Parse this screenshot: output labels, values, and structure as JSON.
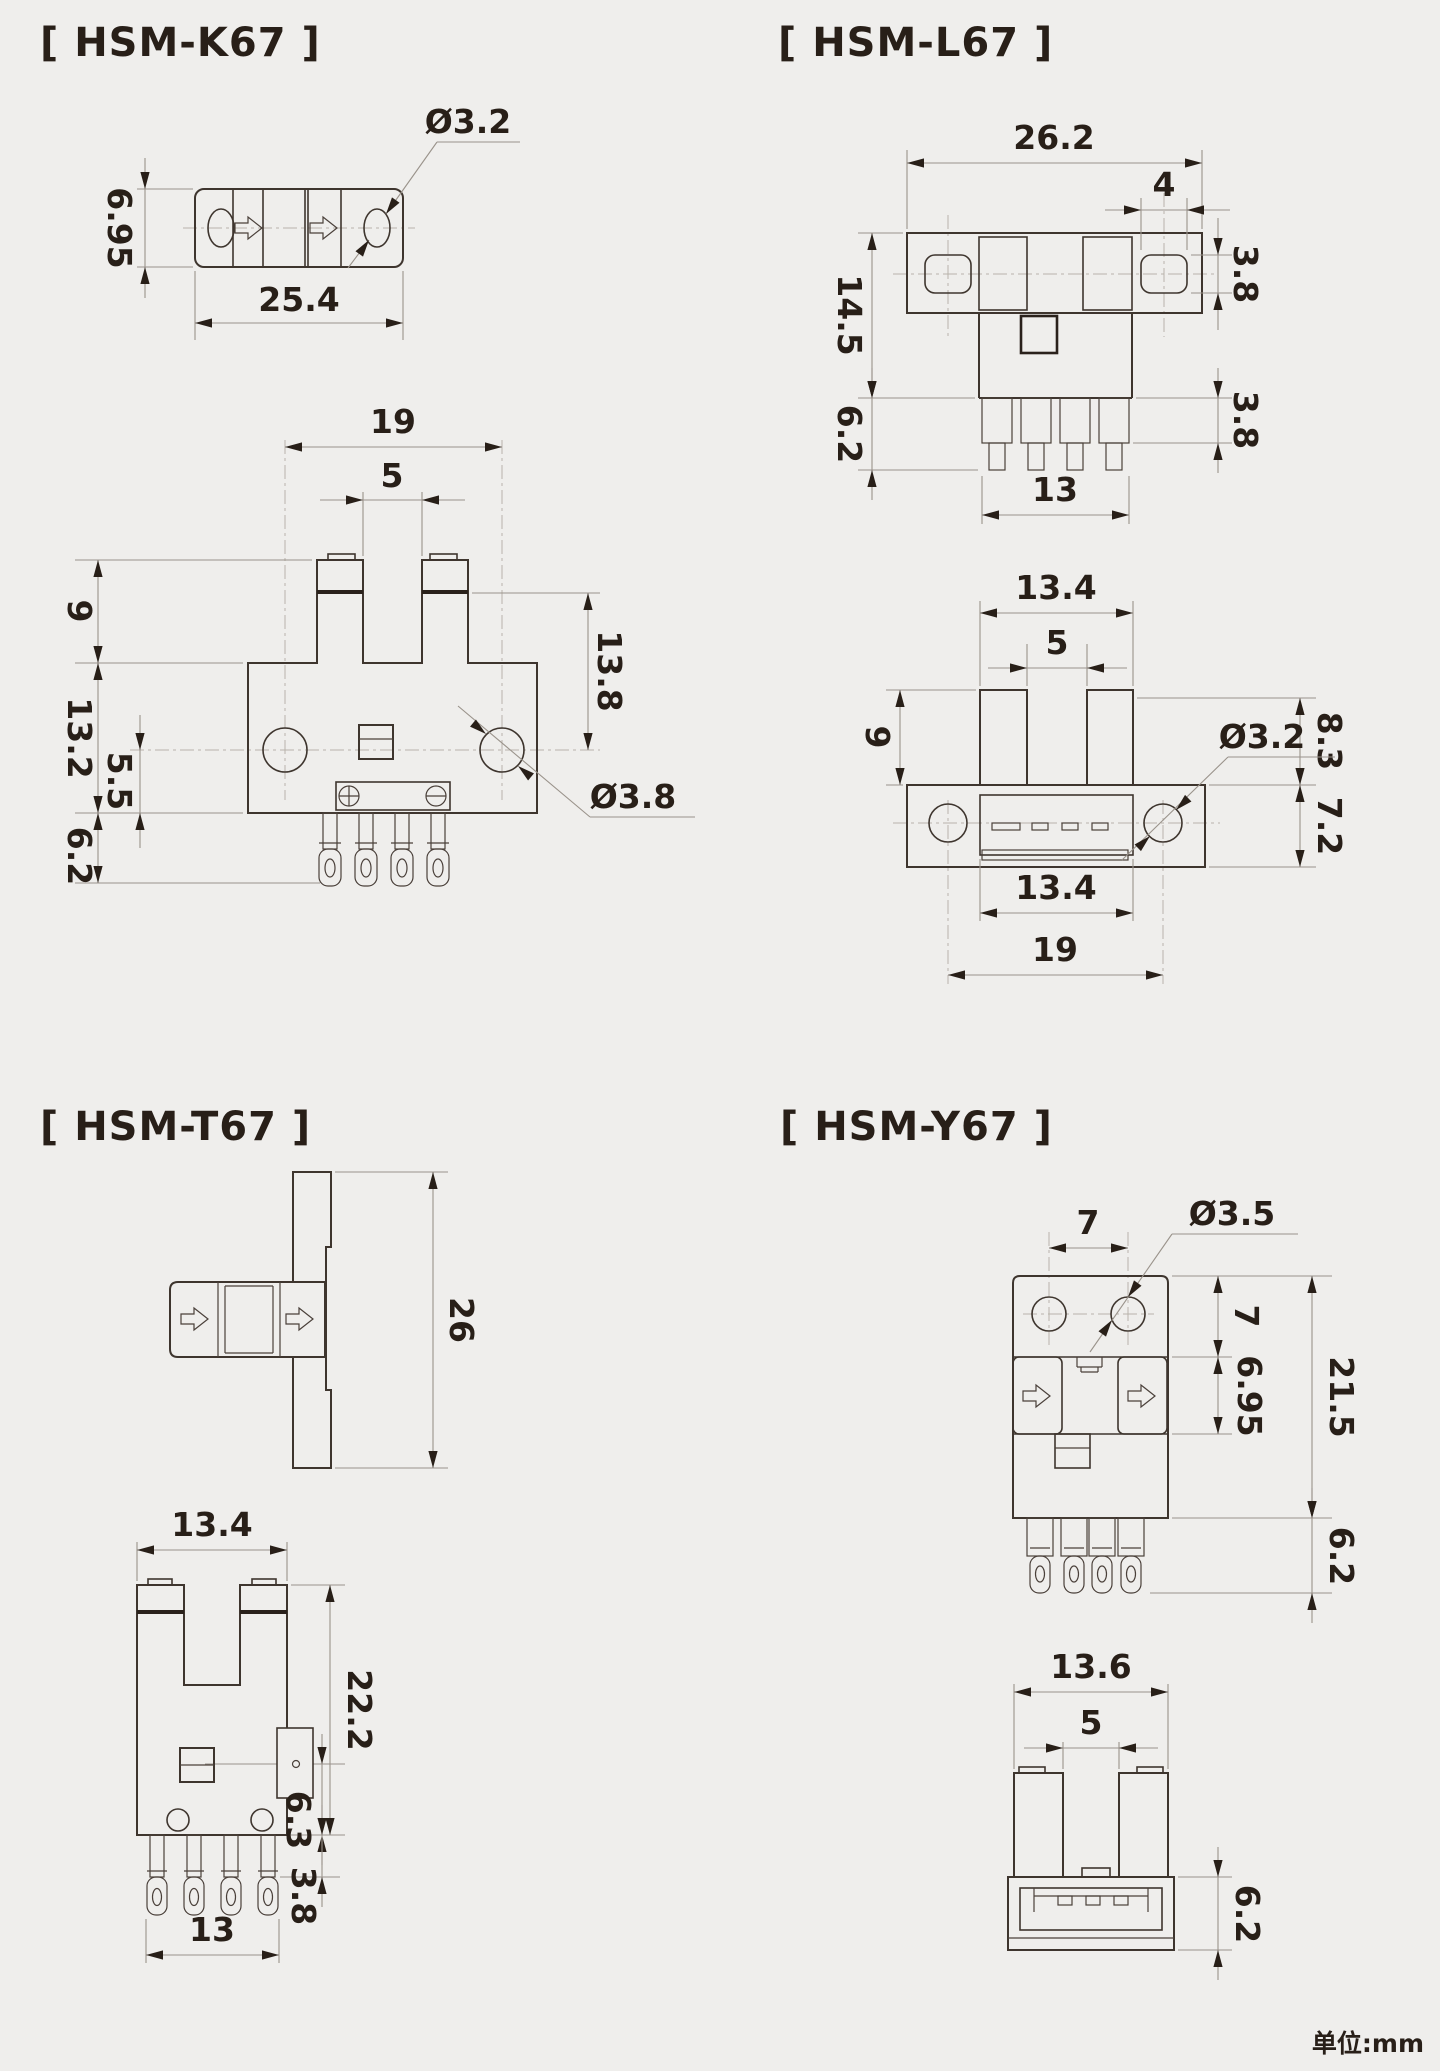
{
  "footer": {
    "units": "单位:mm"
  },
  "k67": {
    "title": "[ HSM-K67 ]",
    "top": {
      "h": "6.95",
      "w": "25.4",
      "dia": "Ø3.2"
    },
    "front": {
      "span": "19",
      "slot": "5",
      "prong": "9",
      "base_h": "13.2",
      "hole_off": "5.5",
      "pin_h": "6.2",
      "depth": "13.8",
      "dia": "Ø3.8"
    }
  },
  "l67": {
    "title": "[ HSM-L67 ]",
    "front": {
      "w": "26.2",
      "hole_w": "4",
      "hole_h": "3.8",
      "h": "14.5",
      "pin_h": "6.2",
      "pin_stage": "3.8",
      "pins_w": "13"
    },
    "bottom": {
      "prong_w": "13.4",
      "slot": "5",
      "prong_len": "9",
      "dia": "Ø3.2",
      "upper_h": "8.3",
      "base_h": "7.2",
      "inner_w": "13.4",
      "span": "19"
    }
  },
  "t67": {
    "title": "[ HSM-T67 ]",
    "side": {
      "h": "26"
    },
    "front": {
      "w": "13.4",
      "h": "22.2",
      "emitter_off": "6.3",
      "pin_stage": "3.8",
      "pins_w": "13"
    }
  },
  "y67": {
    "title": "[ HSM-Y67 ]",
    "front": {
      "span": "7",
      "dia": "Ø3.5",
      "top_h": "7",
      "mid_h": "6.95",
      "h": "21.5",
      "pin_h": "6.2"
    },
    "bottom": {
      "w": "13.6",
      "slot": "5",
      "base_h": "6.2"
    }
  }
}
